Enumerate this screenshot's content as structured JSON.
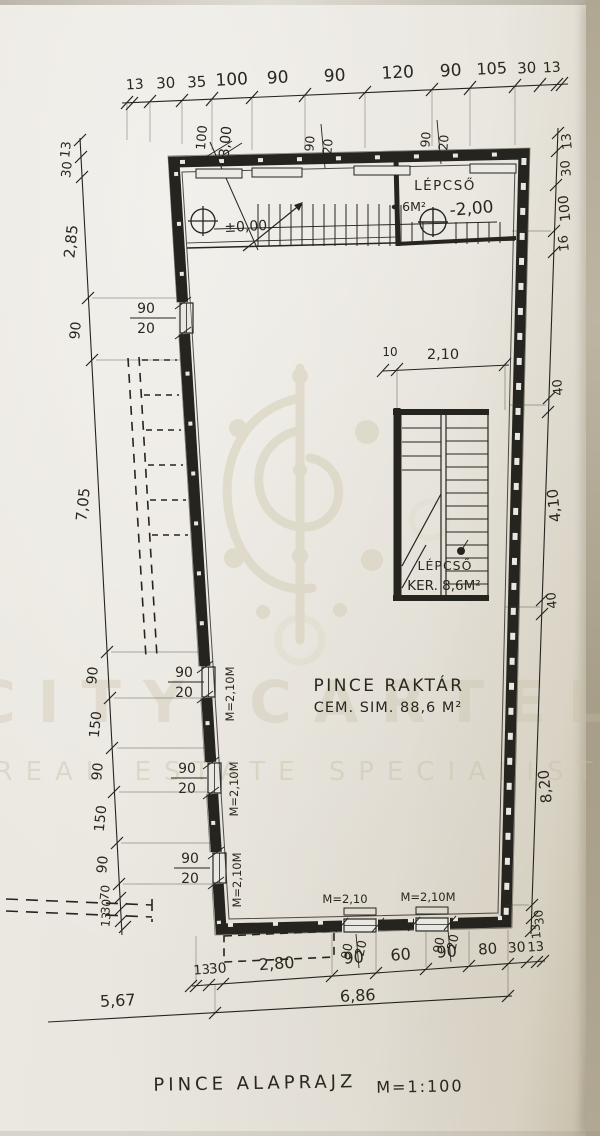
{
  "document": {
    "title": "PINCE ALAPRAJZ",
    "scale": "M=1:100"
  },
  "watermark": {
    "brand": "CITY CARTEL",
    "tagline": "REAL ESTATE SPECIALIST"
  },
  "rooms": {
    "entry": {
      "level_mark": "±0,00"
    },
    "stair_top": {
      "name": "LÉPCSŐ",
      "area": "6M²",
      "level_mark": "-2,00"
    },
    "inner_stair": {
      "name": "LÉPCSŐ",
      "area": "KER. 8,6M²"
    },
    "storage": {
      "name": "PINCE RAKTÁR",
      "finish": "CEM. SIM. 88,6 M²"
    }
  },
  "dims": {
    "top_chain": [
      "13",
      "30",
      "35",
      "100",
      "90",
      "90",
      "120",
      "90",
      "105",
      "30",
      "13"
    ],
    "left_chain": [
      "13",
      "30",
      "2,85",
      "90",
      "7,05",
      "90",
      "150",
      "90",
      "150",
      "90",
      "70",
      "30",
      "13"
    ],
    "right_chain": [
      "13",
      "30",
      "100",
      "16",
      "40",
      "4,10",
      "40",
      "8,20",
      "30",
      "13"
    ],
    "bottom_chain": [
      "13",
      "30",
      "2,80",
      "90",
      "60",
      "90",
      "80",
      "30",
      "13"
    ],
    "overall": [
      "5,67",
      "6,86"
    ],
    "stair_width": [
      "10",
      "2,10"
    ],
    "entry_stair": [
      "100",
      "3,00"
    ],
    "window": {
      "w": "90",
      "h": "20"
    },
    "lintel_full": "M=2,10M",
    "lintel_short": "M=2,10"
  }
}
